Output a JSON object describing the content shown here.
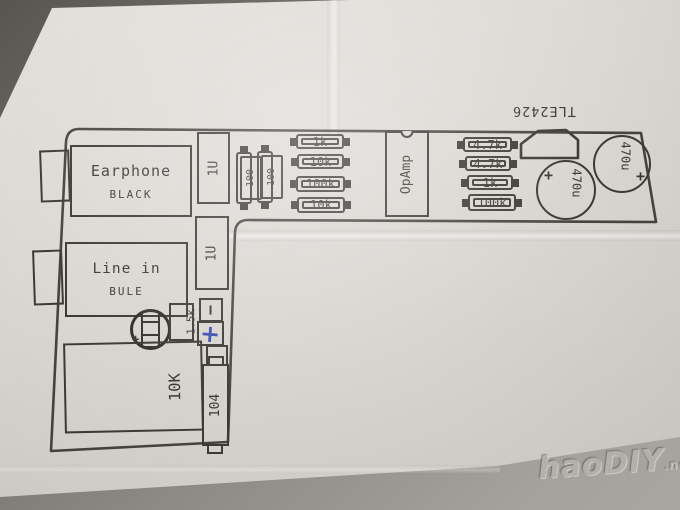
{
  "colors": {
    "ink": "#3c3a35",
    "blue_pen": "#3b4db0",
    "paper": "#dbd8d3",
    "table": "#8b8983"
  },
  "watermark": {
    "name": "haoDIY",
    "suffix": ".net"
  },
  "diagram": {
    "tle_label": "TLE2426",
    "earphone": {
      "title": "Earphone",
      "subtitle": "BLACK"
    },
    "linein": {
      "title": "Line in",
      "subtitle": "BULE"
    },
    "caps_1u": [
      "1U",
      "1U"
    ],
    "r100": [
      "100",
      "100"
    ],
    "left_resistors": [
      "1k",
      "10k",
      "100k",
      "10k"
    ],
    "opamp_label": "OpAmp",
    "right_resistors": [
      "4.7k",
      "4.7k",
      "1k",
      "100k"
    ],
    "caps_470": [
      "470u",
      "470u"
    ],
    "cap470_plus": [
      "+",
      "+"
    ],
    "pot_label": "10K",
    "cap104_label": "104",
    "r15k_label": "1.5k",
    "polarity_minus": "−",
    "polarity_plus": "+",
    "elec_plus": "+"
  }
}
